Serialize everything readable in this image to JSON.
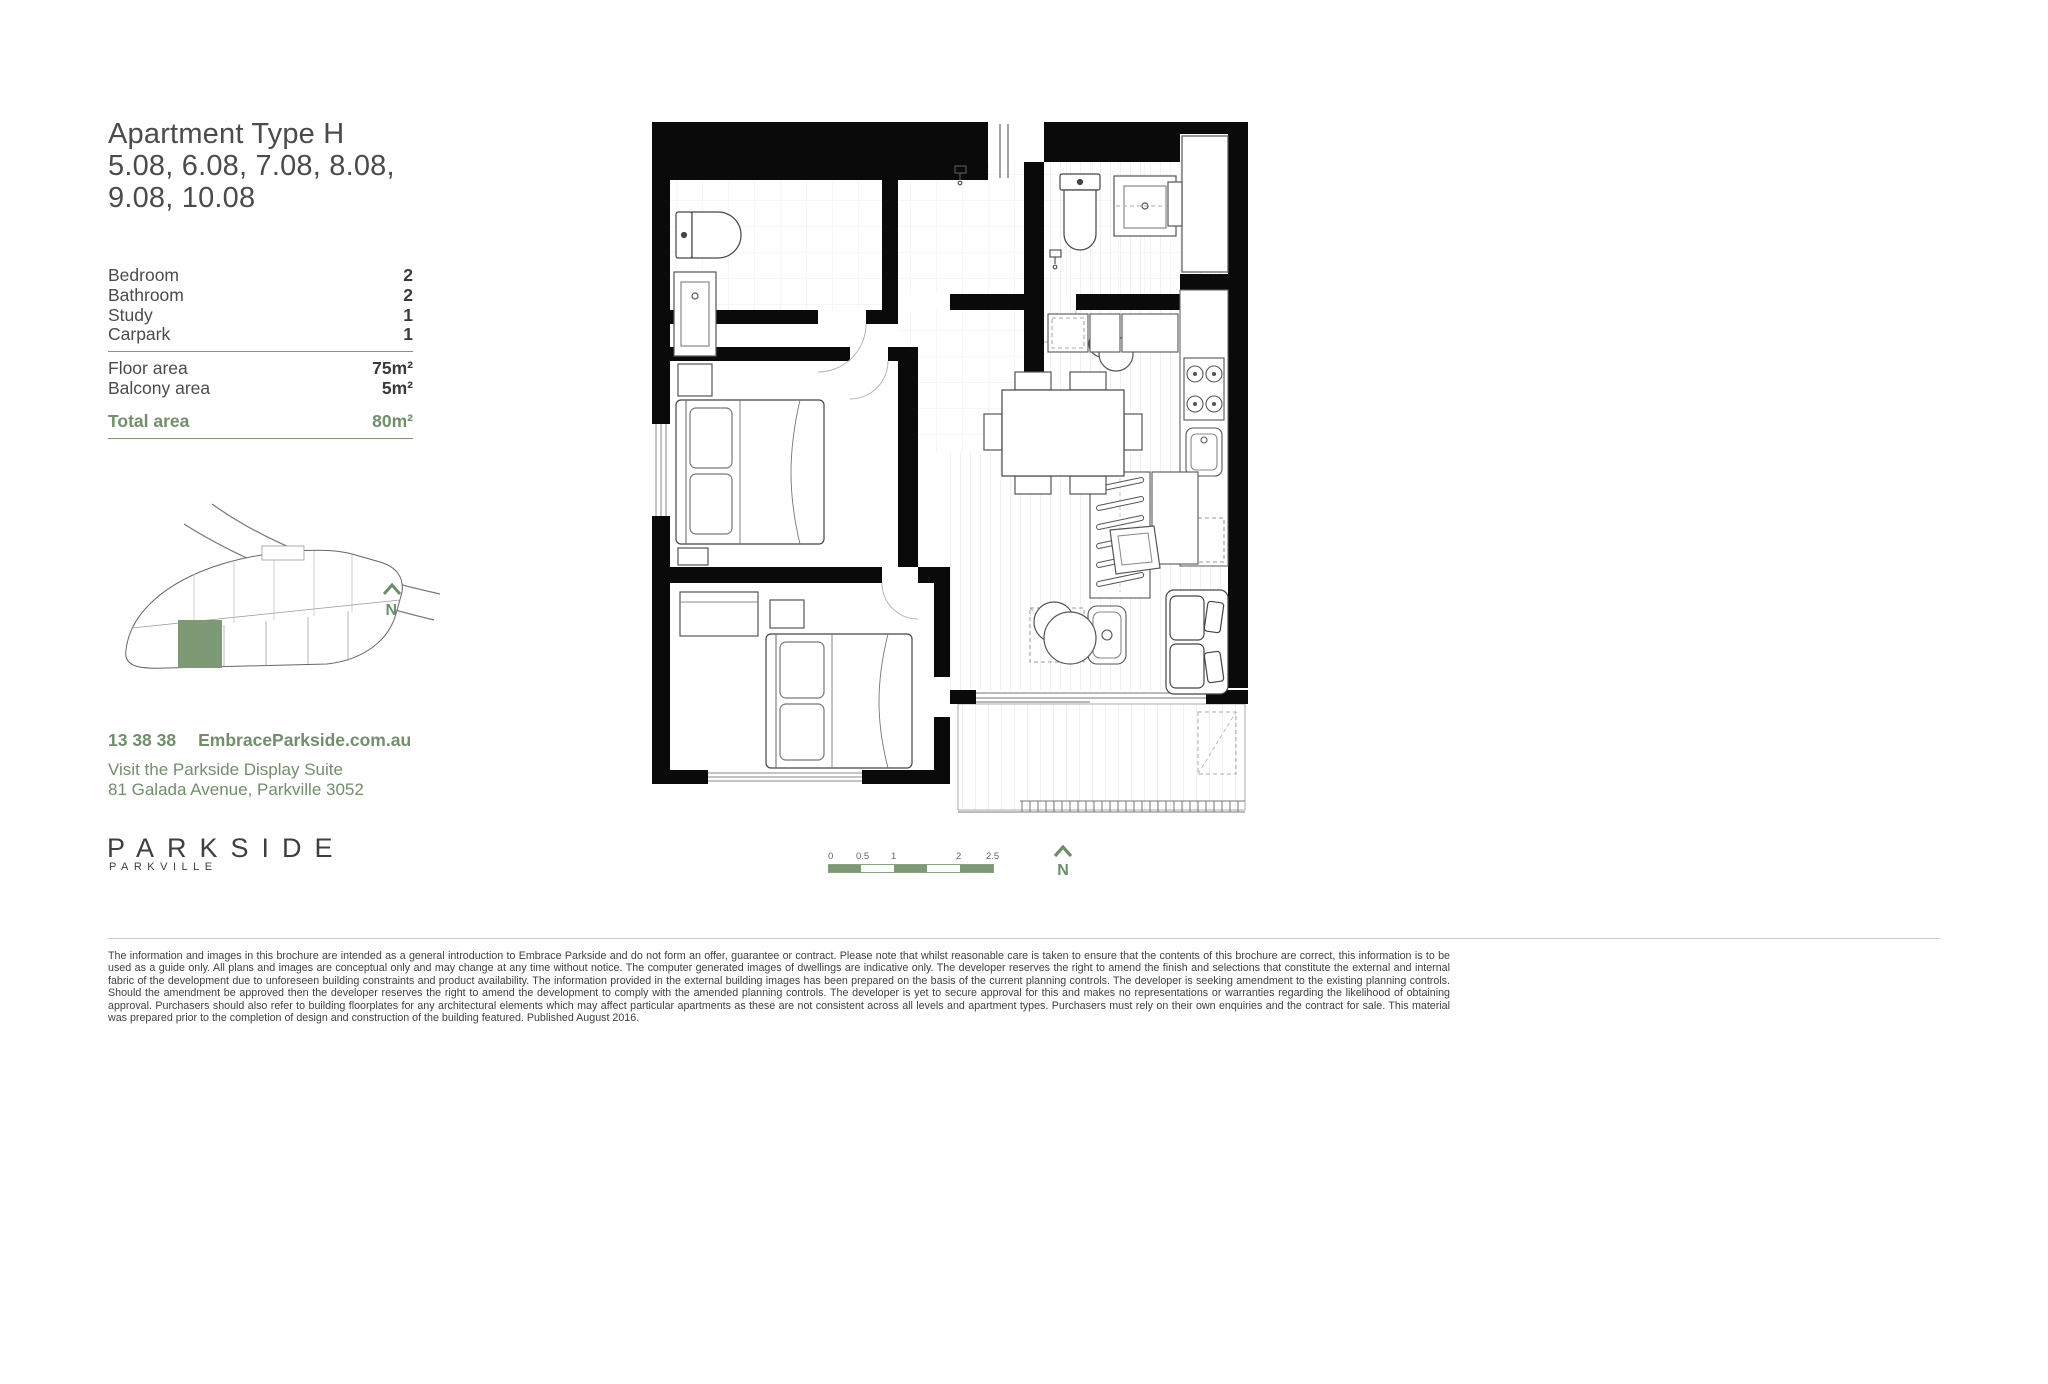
{
  "header": {
    "title_line1": "Apartment Type H",
    "title_line2": "5.08, 6.08, 7.08, 8.08,",
    "title_line3": "9.08, 10.08"
  },
  "specs": {
    "rows": [
      {
        "label": "Bedroom",
        "value": "2"
      },
      {
        "label": "Bathroom",
        "value": "2"
      },
      {
        "label": "Study",
        "value": "1"
      },
      {
        "label": "Carpark",
        "value": "1"
      }
    ],
    "areas": [
      {
        "label": "Floor area",
        "value": "75m²"
      },
      {
        "label": "Balcony area",
        "value": "5m²"
      }
    ],
    "total": {
      "label": "Total area",
      "value": "80m²"
    }
  },
  "site_map": {
    "street_label": "Galada Avenue",
    "north_label": "N",
    "highlight_color": "#7d9a74"
  },
  "contact": {
    "phone": "13 38 38",
    "website": "EmbraceParkside.com.au",
    "line1": "Visit the Parkside Display Suite",
    "line2": "81 Galada Avenue, Parkville 3052"
  },
  "logo": {
    "name": "PARKSIDE",
    "sub": "PARKVILLE"
  },
  "floorplan": {
    "scale_bar": {
      "labels": [
        "0",
        "0.5",
        "1",
        "2",
        "2.5"
      ]
    },
    "north_label": "N"
  },
  "colors": {
    "accent_green_text": "#6f9069",
    "accent_green_fill": "#7d9a74",
    "wall_black": "#0a0a0a"
  },
  "footer": {
    "disclaimer": "The information and images in this brochure are intended as a general introduction to Embrace Parkside and do not form an offer, guarantee or contract. Please note that whilst reasonable care is taken to ensure that the contents of this brochure are correct, this information is to be used as a guide only. All plans and images are conceptual only and may change at any time without notice. The computer generated images of dwellings are indicative only. The developer reserves the right to amend the finish and selections that constitute the external and internal fabric of the development due to unforeseen building constraints and product availability. The information provided in the external building images has been prepared on the basis of the current planning controls. The developer is seeking amendment to the existing planning controls. Should the amendment be approved then the developer reserves the right to amend the development to comply with the amended planning controls. The developer is yet to secure approval for this and makes no representations or warranties regarding the likelihood of obtaining approval. Purchasers should also refer to building floorplates for any architectural elements which may affect particular apartments as these are not consistent across all levels and apartment types. Purchasers must rely on their own enquiries and the contract for sale. This material was prepared prior to the completion of design and construction of the building featured. Published August 2016."
  }
}
